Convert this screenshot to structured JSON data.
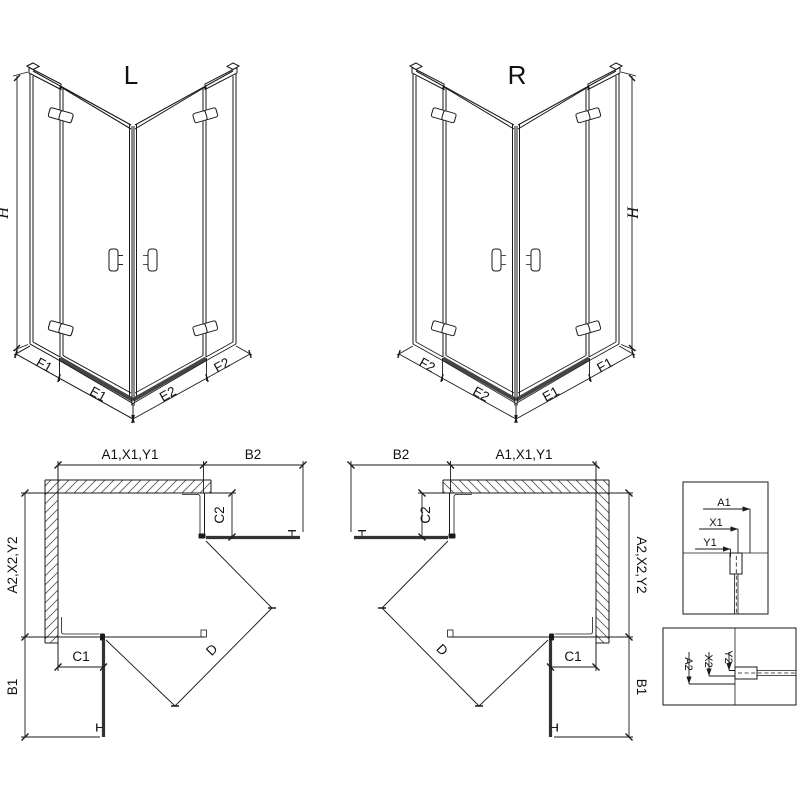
{
  "labels": {
    "variant_left": "L",
    "variant_right": "R",
    "height": "H",
    "f1": "F1",
    "e1": "E1",
    "e2": "E2",
    "f2": "F2",
    "plan_top_chain": "A1,X1,Y1",
    "plan_side_chain": "A2,X2,Y2",
    "b1": "B1",
    "b2": "B2",
    "c1": "C1",
    "c2": "C2",
    "diagonal": "D",
    "detail_a1": "A1",
    "detail_x1": "X1",
    "detail_y1": "Y1",
    "detail_a2": "A2",
    "detail_x2": "X2",
    "detail_y2": "Y2"
  },
  "colors": {
    "line": "#1a1a1a",
    "dim": "#1a1a1a",
    "tray": "#454545",
    "door": "#333333",
    "hatch": "#555555",
    "background": "#ffffff"
  }
}
